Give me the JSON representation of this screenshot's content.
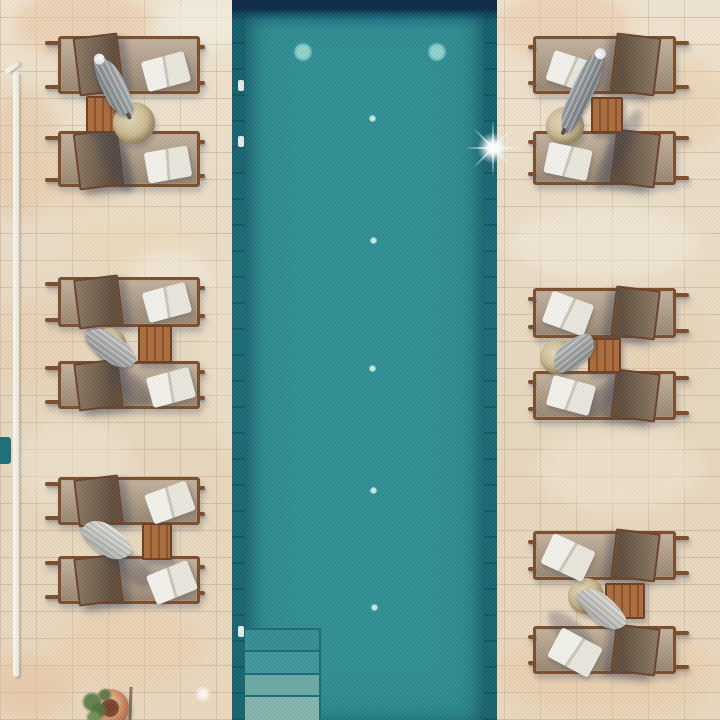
{
  "scene": {
    "label": "Aerial drone view of a teal swimming pool flanked by pairs of wooden sun loungers with white towels, closed parasols and slatted side tables on a beige stone terrace",
    "w": 720,
    "h": 720
  },
  "palette": {
    "pool_teal": "#2b8e95",
    "pool_edge_dark": "#17646f",
    "pool_navy": "#0c2b47",
    "stone_beige": "#ebddc6",
    "lounger_frame": "#7b4e2c",
    "lounger_fabric": "#b09d88",
    "backrest_mesh": "#6b5946",
    "towel_white": "#f2f1eb",
    "table_wood": "#9c6136",
    "parasol_grey": "#9ba1a4",
    "pouf_straw": "#cdbb94",
    "plant_green": "#5f7a49",
    "pot_terracotta": "#c47e57"
  },
  "stone_patches": [
    [
      15,
      -12,
      135,
      72,
      "#eac39e",
      0.55
    ],
    [
      160,
      -5,
      95,
      52,
      "#f6f2e6",
      0.6
    ],
    [
      -15,
      85,
      75,
      135,
      "#e2bd96",
      0.4
    ],
    [
      30,
      148,
      85,
      62,
      "#efcfae",
      0.45
    ],
    [
      68,
      213,
      132,
      62,
      "#ecd9b8",
      0.5
    ],
    [
      130,
      248,
      82,
      62,
      "#f4efe2",
      0.55
    ],
    [
      -10,
      298,
      92,
      92,
      "#e9c9a6",
      0.4
    ],
    [
      18,
      418,
      112,
      92,
      "#f1e7d4",
      0.5
    ],
    [
      58,
      608,
      142,
      82,
      "#ecc9a4",
      0.45
    ],
    [
      -18,
      655,
      95,
      65,
      "#e6c19c",
      0.5
    ],
    [
      498,
      -10,
      132,
      72,
      "#eac3a0",
      0.5
    ],
    [
      638,
      58,
      92,
      92,
      "#e9cba8",
      0.45
    ],
    [
      508,
      208,
      192,
      72,
      "#f3eddd",
      0.55
    ],
    [
      598,
      298,
      112,
      92,
      "#ebcfae",
      0.4
    ],
    [
      538,
      428,
      162,
      82,
      "#f2e9d6",
      0.5
    ],
    [
      498,
      628,
      215,
      92,
      "#e8c7a2",
      0.45
    ],
    [
      298,
      658,
      165,
      62,
      "#eeddc0",
      0.5
    ],
    [
      205,
      248,
      62,
      205,
      "#f0e8d6",
      0.4
    ]
  ],
  "pool": {
    "x": 232,
    "y": 0,
    "w": 265,
    "h": 720,
    "edge_w": 13,
    "lights": [
      {
        "x": 71,
        "y": 52
      },
      {
        "x": 205,
        "y": 52
      }
    ],
    "dots": [
      {
        "x": 140,
        "y": 118
      },
      {
        "x": 141,
        "y": 240
      },
      {
        "x": 140,
        "y": 368
      },
      {
        "x": 141,
        "y": 490
      },
      {
        "x": 142,
        "y": 607
      }
    ],
    "steps": {
      "x": 13,
      "w": 76,
      "rows": [
        {
          "y": 628,
          "h": 22,
          "c": "#2f8a91"
        },
        {
          "y": 650,
          "h": 23,
          "c": "#3a939b"
        },
        {
          "y": 673,
          "h": 22,
          "c": "#67a6a0"
        },
        {
          "y": 695,
          "h": 25,
          "c": "#7fb1aa"
        }
      ]
    },
    "fittings": [
      {
        "y": 80
      },
      {
        "y": 136
      },
      {
        "y": 626
      }
    ],
    "glint": {
      "x": 261,
      "y": 148
    }
  },
  "pole": {
    "x": 13,
    "y": 71,
    "w": 6,
    "h": 606
  },
  "accents": {
    "teal_patch": {
      "x": -3,
      "y": 437,
      "w": 14,
      "h": 27,
      "c": "#1d6e7b"
    },
    "rod": {
      "x": 129,
      "y": 687,
      "w": 3,
      "h": 33
    },
    "disc": {
      "x": 203,
      "y": 694,
      "r": 8
    },
    "pot": {
      "cx": 110,
      "cy": 708,
      "r": 19
    }
  },
  "groups": [
    {
      "id": "top-left",
      "side": "left",
      "loungers": [
        {
          "x": 58,
          "y": 36,
          "w": 142,
          "h": 58
        },
        {
          "x": 58,
          "y": 131,
          "w": 142,
          "h": 56
        }
      ],
      "table": {
        "x": 86,
        "y": 96,
        "w": 31,
        "h": 37
      },
      "pouf": {
        "x": 134,
        "y": 123,
        "r": 21
      },
      "umbrella": {
        "x": 114,
        "y": 87,
        "len": 66,
        "wid": 24,
        "rot": 63,
        "c": "#9ba1a4",
        "cap": "left"
      },
      "shadow": {
        "x": 115,
        "y": 160,
        "len": 70,
        "wid": 24,
        "rot": 65
      },
      "towels": [
        {
          "x": 166,
          "y": 71,
          "w": 44,
          "h": 31,
          "rot": -15
        },
        {
          "x": 168,
          "y": 164,
          "w": 44,
          "h": 31,
          "rot": -10
        }
      ]
    },
    {
      "id": "middle-left",
      "side": "left",
      "loungers": [
        {
          "x": 58,
          "y": 277,
          "w": 142,
          "h": 50
        },
        {
          "x": 58,
          "y": 361,
          "w": 142,
          "h": 48
        }
      ],
      "table": {
        "x": 138,
        "y": 325,
        "w": 34,
        "h": 38
      },
      "pouf": {
        "x": 110,
        "y": 344,
        "r": 16
      },
      "umbrella": {
        "x": 111,
        "y": 348,
        "len": 56,
        "wid": 26,
        "rot": 36,
        "c": "#b7b9b7"
      },
      "shadow": {
        "x": 128,
        "y": 385,
        "len": 55,
        "wid": 22,
        "rot": 42
      },
      "towels": [
        {
          "x": 167,
          "y": 302,
          "w": 44,
          "h": 31,
          "rot": -15
        },
        {
          "x": 171,
          "y": 387,
          "w": 44,
          "h": 31,
          "rot": -15
        }
      ]
    },
    {
      "id": "bottom-left",
      "side": "left",
      "loungers": [
        {
          "x": 58,
          "y": 477,
          "w": 142,
          "h": 48
        },
        {
          "x": 58,
          "y": 556,
          "w": 142,
          "h": 48
        }
      ],
      "table": {
        "x": 142,
        "y": 523,
        "w": 30,
        "h": 37
      },
      "umbrella": {
        "x": 107,
        "y": 540,
        "len": 54,
        "wid": 28,
        "rot": 35,
        "c": "#d7d6d0"
      },
      "shadow": {
        "x": 128,
        "y": 565,
        "len": 60,
        "wid": 24,
        "rot": 40
      },
      "towels": [
        {
          "x": 170,
          "y": 502,
          "w": 44,
          "h": 31,
          "rot": -20
        },
        {
          "x": 172,
          "y": 582,
          "w": 44,
          "h": 31,
          "rot": -22
        }
      ]
    },
    {
      "id": "top-right",
      "side": "right",
      "loungers": [
        {
          "x": 533,
          "y": 36,
          "w": 143,
          "h": 58
        },
        {
          "x": 533,
          "y": 131,
          "w": 143,
          "h": 54
        }
      ],
      "table": {
        "x": 591,
        "y": 97,
        "w": 32,
        "h": 36
      },
      "pouf": {
        "x": 565,
        "y": 126,
        "r": 19
      },
      "umbrella": {
        "x": 582,
        "y": 92,
        "len": 88,
        "wid": 22,
        "rot": -65,
        "c": "#8f9598",
        "cap": "right"
      },
      "shadow": {
        "x": 618,
        "y": 150,
        "len": 90,
        "wid": 20,
        "rot": -60
      },
      "towels": [
        {
          "x": 571,
          "y": 71,
          "w": 44,
          "h": 31,
          "rot": 18
        },
        {
          "x": 568,
          "y": 161,
          "w": 44,
          "h": 31,
          "rot": 12
        }
      ]
    },
    {
      "id": "middle-right",
      "side": "right",
      "loungers": [
        {
          "x": 533,
          "y": 288,
          "w": 143,
          "h": 50
        },
        {
          "x": 533,
          "y": 371,
          "w": 143,
          "h": 49
        }
      ],
      "table": {
        "x": 588,
        "y": 338,
        "w": 33,
        "h": 35
      },
      "pouf": {
        "x": 557,
        "y": 357,
        "r": 17
      },
      "umbrella": {
        "x": 574,
        "y": 353,
        "len": 48,
        "wid": 26,
        "rot": -38,
        "c": "#a9aca9"
      },
      "shadow": {
        "x": 600,
        "y": 400,
        "len": 50,
        "wid": 20,
        "rot": -45
      },
      "towels": [
        {
          "x": 568,
          "y": 313,
          "w": 44,
          "h": 33,
          "rot": 20
        },
        {
          "x": 571,
          "y": 395,
          "w": 44,
          "h": 31,
          "rot": 15
        }
      ]
    },
    {
      "id": "bottom-right",
      "side": "right",
      "loungers": [
        {
          "x": 533,
          "y": 531,
          "w": 143,
          "h": 49
        },
        {
          "x": 533,
          "y": 626,
          "w": 143,
          "h": 48
        }
      ],
      "table": {
        "x": 605,
        "y": 583,
        "w": 40,
        "h": 36
      },
      "pouf": {
        "x": 586,
        "y": 596,
        "r": 18
      },
      "umbrella": {
        "x": 602,
        "y": 609,
        "len": 56,
        "wid": 26,
        "rot": 40,
        "c": "#d5d3cc"
      },
      "shadow": {
        "x": 572,
        "y": 634,
        "len": 62,
        "wid": 24,
        "rot": 45
      },
      "towels": [
        {
          "x": 568,
          "y": 557,
          "w": 46,
          "h": 33,
          "rot": 25
        },
        {
          "x": 575,
          "y": 652,
          "w": 46,
          "h": 33,
          "rot": 28
        }
      ]
    }
  ]
}
